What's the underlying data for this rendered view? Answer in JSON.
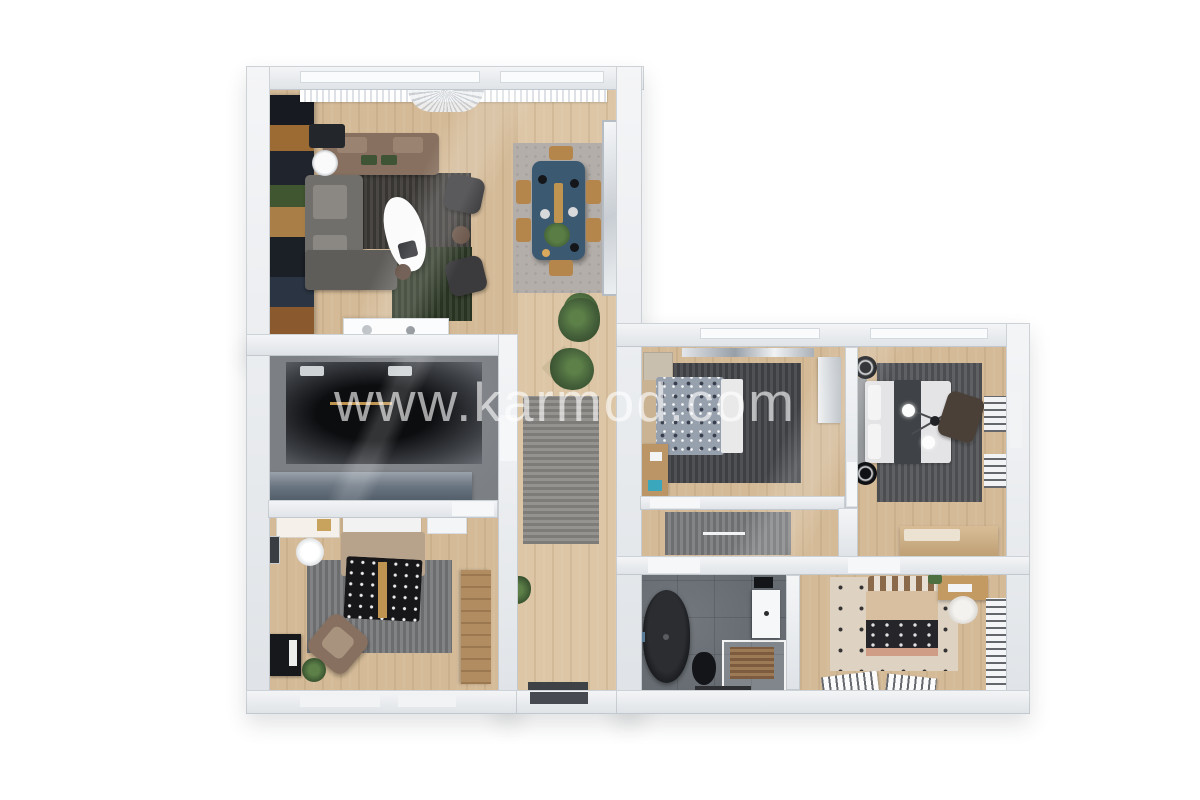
{
  "watermark": {
    "text": "www.karmod.com"
  },
  "palette": {
    "background": "#ffffff",
    "wall_top": "#f4f5f7",
    "wall_side": "#dfe3e7",
    "wood": "#d4ba97",
    "wood_light": "#dcc6a6",
    "media_floor": "#7c8085",
    "bath_floor": "#666c72",
    "rug_dark": "#403d3a",
    "rug_green": "#2f3a27",
    "rug_dining": "#b3aeaa",
    "rug_gray": "#7b7c7e",
    "rug_middark": "#46484c",
    "rug_master": "#56585c",
    "rug_corridor": "#7d7e81",
    "rug_beige": "#ded3c3",
    "sofa_brown": "#87705f",
    "sofa_gray": "#716f6b",
    "armchair_dark": "#3b3b3d",
    "dining_table": "#3c5972",
    "chair_wood": "#b5864c",
    "console_slate": "#6b7682",
    "black": "#17181b",
    "bed_tan": "#b7a28b",
    "duvet_blue": "#97a0ad",
    "bed_tan2": "#d8bf9f",
    "salmon": "#cf9d85",
    "plant": "#44603a",
    "accent_gold": "#bf9350",
    "watermark": "rgba(255,255,255,0.62)"
  },
  "rooms": [
    {
      "id": "living-room",
      "furniture": [
        "kitchen-shelving",
        "brown-sofa",
        "gray-corner-sofa",
        "coffee-table",
        "armchairs",
        "dark-rug",
        "green-rug",
        "dining-rug",
        "dining-table",
        "dining-chairs",
        "sideboard",
        "curtains",
        "ceiling-fan",
        "mirror",
        "plant"
      ]
    },
    {
      "id": "media-room",
      "furniture": [
        "dark-rug",
        "tv-console"
      ]
    },
    {
      "id": "bedroom-left",
      "furniture": [
        "double-bed",
        "gray-rug",
        "desk",
        "round-chair",
        "armchair",
        "dresser",
        "wardrobe",
        "plant"
      ]
    },
    {
      "id": "hallway",
      "furniture": [
        "runner-rug",
        "plants",
        "corner-shelf",
        "entry-door"
      ]
    },
    {
      "id": "bedroom-middle",
      "furniture": [
        "single-bed",
        "dark-rug",
        "desk",
        "wardrobe",
        "wall-shelf",
        "cabinet"
      ]
    },
    {
      "id": "master-bedroom",
      "furniture": [
        "double-bed",
        "rug",
        "side-tables",
        "chandelier",
        "wall-shelves",
        "chest",
        "throw-chair"
      ]
    },
    {
      "id": "corridor",
      "furniture": [
        "runner-rug"
      ]
    },
    {
      "id": "bathroom",
      "furniture": [
        "bathtub",
        "toilet",
        "shower",
        "vanity"
      ]
    },
    {
      "id": "bedroom-bottom-right",
      "furniture": [
        "double-bed",
        "dotted-rug",
        "desk",
        "round-chair",
        "slatted-benches",
        "wall-panels"
      ]
    }
  ]
}
